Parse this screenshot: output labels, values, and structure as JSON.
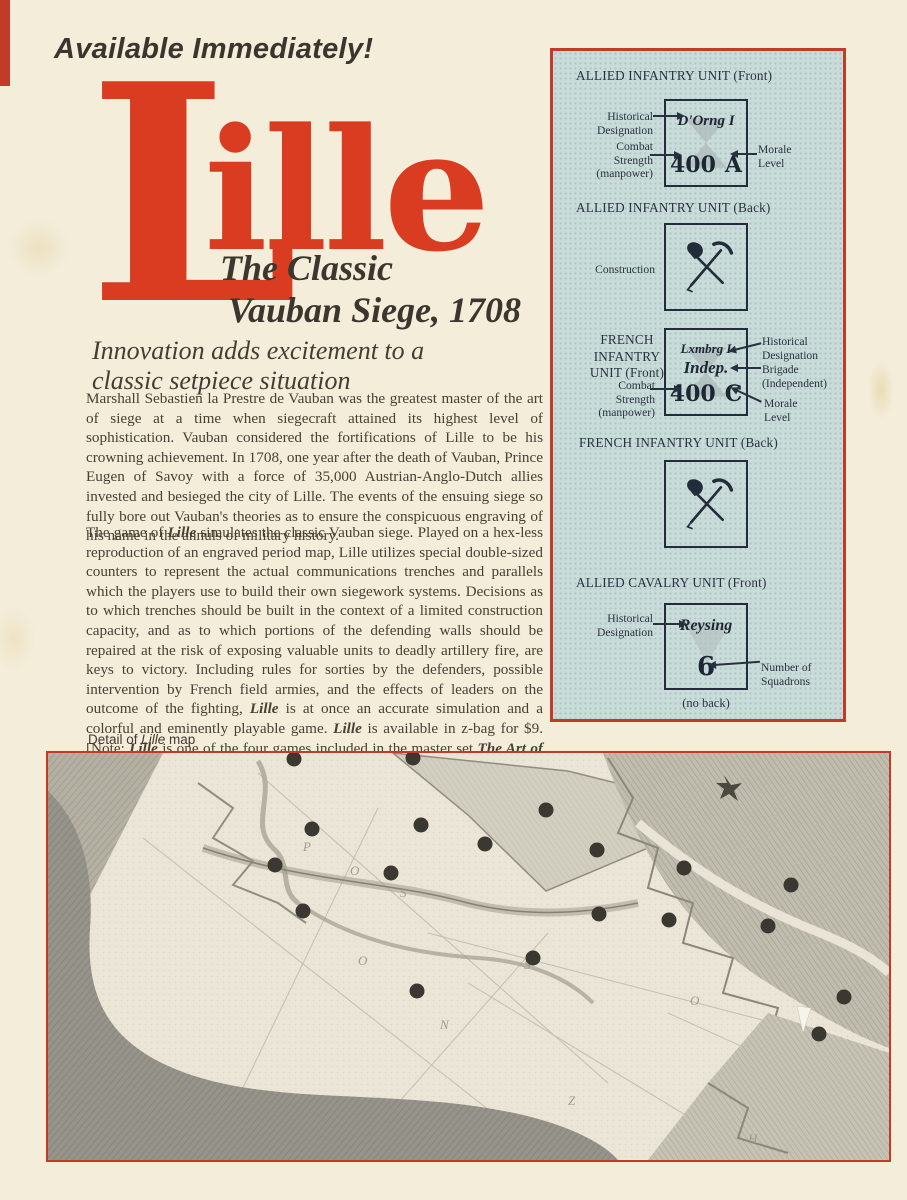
{
  "page": {
    "banner": "Available Immediately!",
    "colors": {
      "accent_red": "#c23a28",
      "logo_red": "#da3c22",
      "paper": "#f3edda",
      "ink": "#474135",
      "sidebar_bg": "#cadcd9"
    }
  },
  "logo": {
    "big_letter": "L",
    "rest": "ille",
    "subtitle1": "The Classic",
    "subtitle2": "Vauban Siege, 1708"
  },
  "intro_heading": "Innovation adds excitement to a\nclassic setpiece situation",
  "body": {
    "para1": "Marshall Sebastien la Prestre de Vauban was the greatest master of the art of siege at a time when siegecraft attained its highest level of sophistication. Vauban considered the fortifications of Lille to be his crowning achievement. In 1708, one year after the death of Vauban, Prince Eugen of Savoy with a force of 35,000 Austrian-Anglo-Dutch allies invested and besieged the city of Lille. The events of the ensuing siege so fully bore out Vauban's theories as to ensure the conspicuous engraving of his name in the annuls of military history.",
    "para2_segments": [
      {
        "t": "The game of "
      },
      {
        "t": "Lille",
        "s": "bi"
      },
      {
        "t": " simulates the classic Vauban siege. Played on a hex-less reproduction of an engraved period map, Lille utilizes special double-sized counters to represent the actual communications trenches and parallels which the players use to build their own siegework systems. Decisions as to which trenches should be built in the context of a limited construction capacity, and as to which portions of the defending walls should be repaired at the risk of exposing valuable units to deadly artillery fire, are keys to victory. Including rules for sorties by the defenders, possible intervention by French field armies, and the effects of leaders on the outcome of the fighting, "
      },
      {
        "t": "Lille",
        "s": "bi"
      },
      {
        "t": " is at once an accurate simulation and a colorful and eminently playable game. "
      },
      {
        "t": "Lille",
        "s": "bi"
      },
      {
        "t": " is available in z-bag for $9. [Note: "
      },
      {
        "t": "Lille",
        "s": "bi"
      },
      {
        "t": " is one of the four games included in the master set "
      },
      {
        "t": "The Art of Siege",
        "s": "bi"
      },
      {
        "t": ". See the Special Offer pages for a sale price of this set.]"
      }
    ]
  },
  "sidebar": {
    "s1": {
      "heading": "ALLIED INFANTRY UNIT (Front)",
      "designation": "D'Orng I",
      "strength": "400",
      "morale": "A",
      "label_historical": "Historical\nDesignation",
      "label_combat": "Combat\nStrength\n(manpower)",
      "label_morale": "Morale\nLevel"
    },
    "s2": {
      "heading": "ALLIED INFANTRY UNIT (Back)",
      "label_construction": "Construction"
    },
    "s3": {
      "heading": "FRENCH\nINFANTRY\nUNIT (Front)",
      "designation": "Lxmbrg I",
      "brigade": "Indep.",
      "strength": "400",
      "morale": "C",
      "label_historical": "Historical\nDesignation",
      "label_brigade": "Brigade\n(Independent)",
      "label_morale": "Morale\nLevel",
      "label_combat": "Combat\nStrength\n(manpower)"
    },
    "s4": {
      "heading": "FRENCH INFANTRY UNIT (Back)"
    },
    "s5": {
      "heading": "ALLIED CAVALRY UNIT (Front)",
      "designation": "Reysing",
      "squadrons": "6",
      "label_historical": "Historical\nDesignation",
      "label_squadrons": "Number of\nSquadrons",
      "note": "(no back)"
    }
  },
  "map": {
    "caption_segments": [
      {
        "t": "Detail of "
      },
      {
        "t": "Lille",
        "s": "i"
      },
      {
        "t": " map"
      }
    ],
    "dots": [
      [
        246,
        6
      ],
      [
        365,
        5
      ],
      [
        264,
        76
      ],
      [
        373,
        72
      ],
      [
        227,
        112
      ],
      [
        343,
        120
      ],
      [
        255,
        158
      ],
      [
        498,
        57
      ],
      [
        437,
        91
      ],
      [
        549,
        97
      ],
      [
        636,
        115
      ],
      [
        743,
        132
      ],
      [
        551,
        161
      ],
      [
        621,
        167
      ],
      [
        720,
        173
      ],
      [
        485,
        205
      ],
      [
        369,
        238
      ],
      [
        796,
        244
      ],
      [
        771,
        281
      ]
    ],
    "engraved_letters": [
      {
        "t": "P",
        "x": 255,
        "y": 98
      },
      {
        "t": "O",
        "x": 302,
        "y": 122
      },
      {
        "t": "S",
        "x": 352,
        "y": 144
      },
      {
        "t": "O",
        "x": 310,
        "y": 212
      },
      {
        "t": "N",
        "x": 392,
        "y": 276
      },
      {
        "t": "S",
        "x": 476,
        "y": 216
      },
      {
        "t": "Z",
        "x": 520,
        "y": 352
      },
      {
        "t": "O",
        "x": 642,
        "y": 252
      },
      {
        "t": "H",
        "x": 700,
        "y": 390
      }
    ]
  }
}
